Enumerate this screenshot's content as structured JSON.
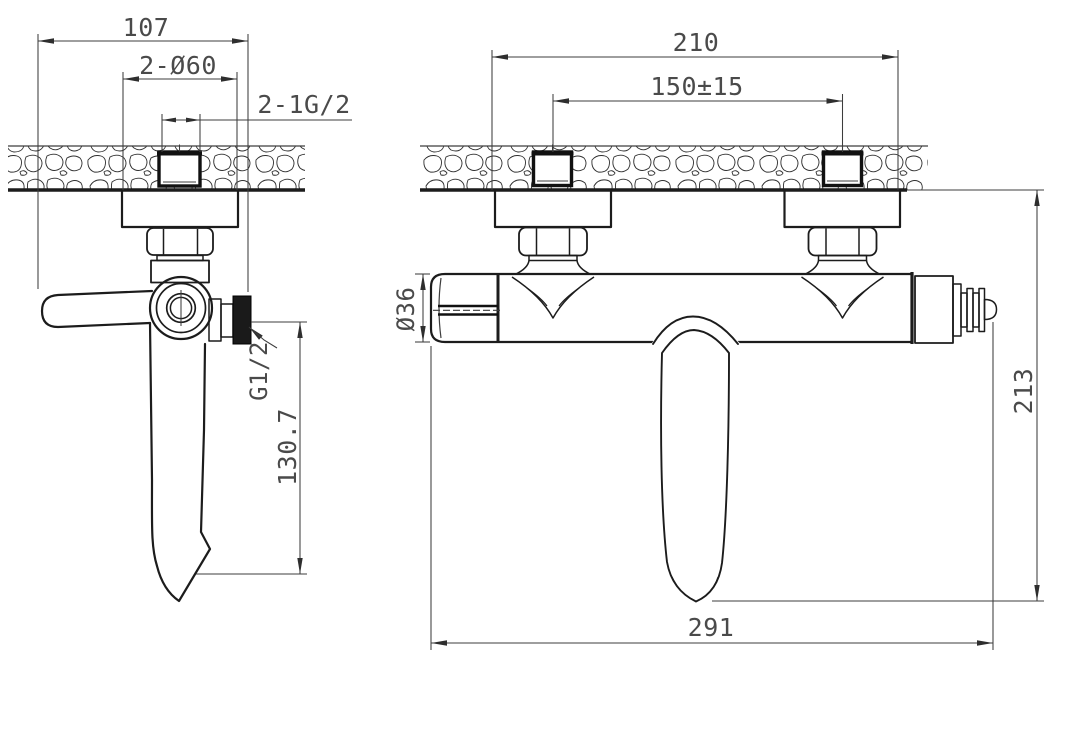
{
  "drawing": {
    "type": "technical-dimension-drawing",
    "subject": "Wall-mounted bathtub mixer tap - installation dimensions, side view and front view",
    "units": "mm",
    "side_view": {
      "dim_overall_depth": "107",
      "dim_escutcheon_diameter": "2-Ø60",
      "dim_inlet_thread": "2-1G/2",
      "dim_outlet_thread": "G1/2",
      "dim_spout_drop": "130.7"
    },
    "front_view": {
      "dim_escutcheon_span": "210",
      "dim_inlet_spacing": "150±15",
      "dim_body_diameter": "Ø36",
      "dim_overall_height": "213",
      "dim_overall_length": "291"
    },
    "colors": {
      "background": "#ffffff",
      "object_line": "#1c1c1c",
      "dimension_line": "#3d3d3d",
      "dimension_text": "#4a4a4a"
    }
  }
}
